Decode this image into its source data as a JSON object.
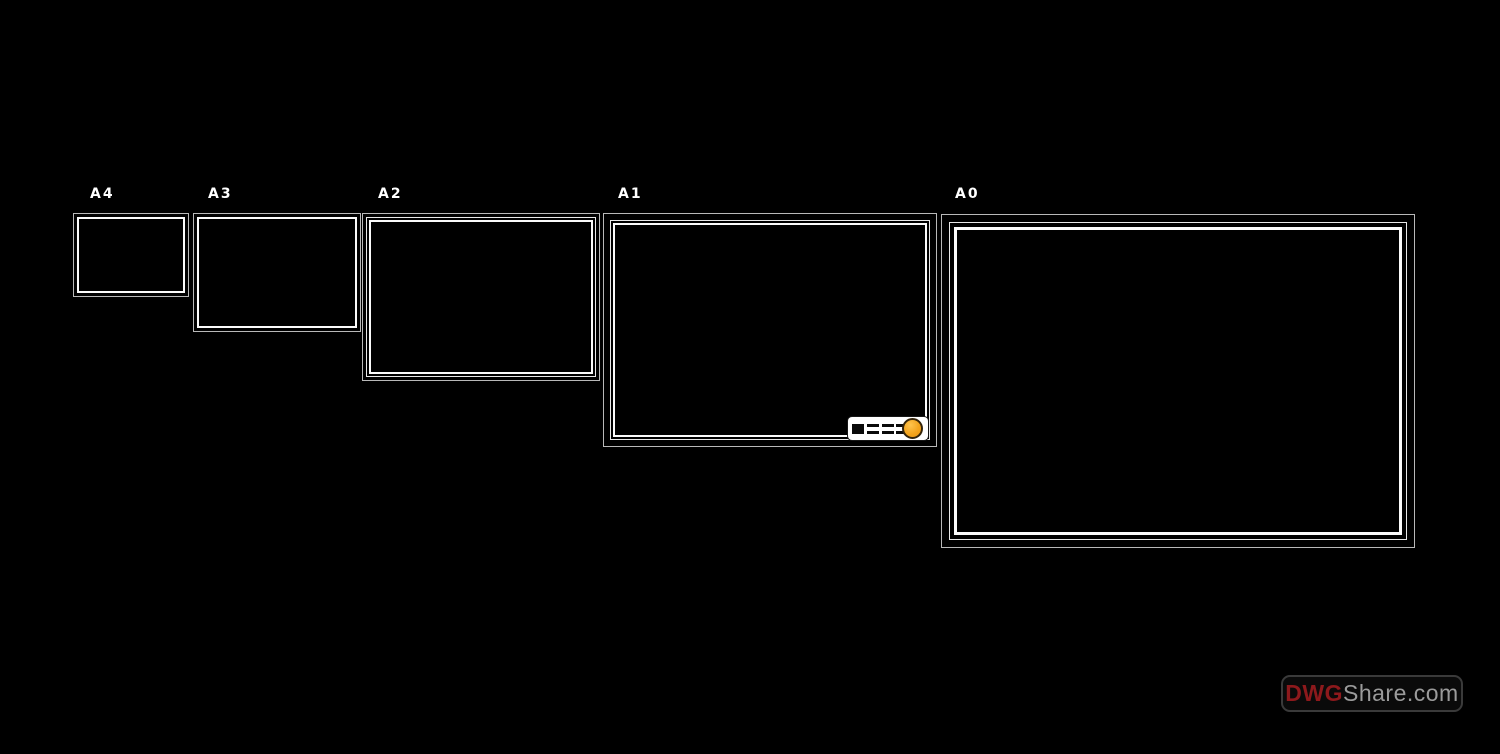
{
  "background": "#000000",
  "frames": [
    {
      "label": "A4"
    },
    {
      "label": "A3"
    },
    {
      "label": "A2"
    },
    {
      "label": "A1"
    },
    {
      "label": "A0"
    }
  ],
  "title_block": {
    "fill_color": "#ffffff",
    "dot_color": "#f3a41d",
    "dot_ring_color": "#34240a",
    "glyph_color": "#0a0a0a"
  },
  "watermark": {
    "prefix": "DWG",
    "suffix": "Share.com",
    "prefix_color": "#8d191c",
    "suffix_color": "#9b9b9b",
    "border_color": "#3a3a3a"
  },
  "line_colors": {
    "outer": "#b9b9b9",
    "mid": "#e8e8e8",
    "inner": "#fbfbfb"
  }
}
